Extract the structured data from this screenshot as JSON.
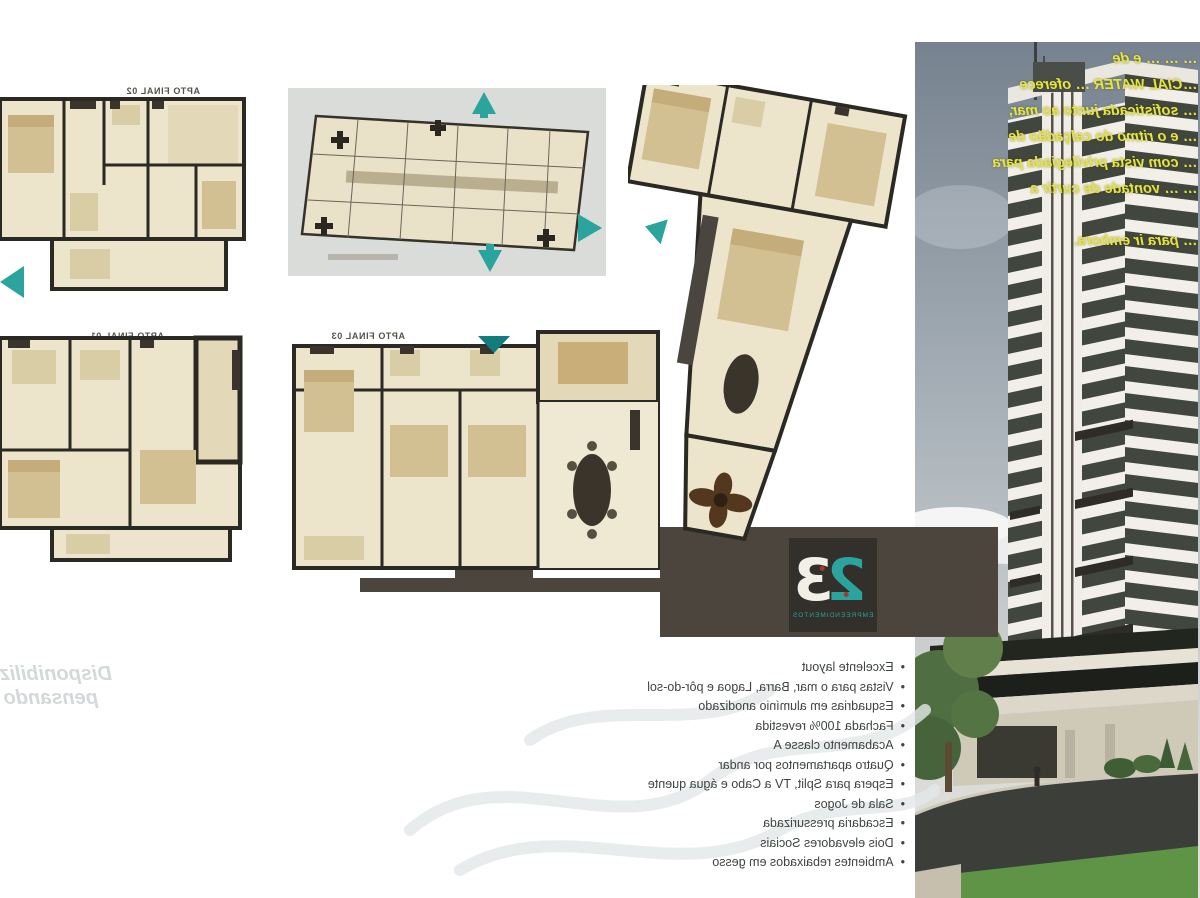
{
  "document": {
    "kind": "real-estate brochure (mirrored print)"
  },
  "plans": {
    "plan_02": {
      "label": "APTO FINAL 02"
    },
    "plan_01": {
      "label": "APTO FINAL 01"
    },
    "plan_03": {
      "label": "APTO FINAL 03"
    },
    "plan_06": {
      "label": "APTO FINAL 06"
    },
    "keyplan": {
      "title": "PAVIMENTO TIPO"
    }
  },
  "logo": {
    "digits_teal": "2",
    "digits_white": "3",
    "caption": "EMPREENDIMENTOS"
  },
  "promo": {
    "lines": [
      "… … … e de",
      "…CIAL WATER … oferece",
      "… sofisticada junto ao mar,",
      "… e o ritmo do calçadão de",
      "… com vista privilegiada para",
      "… … vontade de curtir a",
      "",
      "… para ir embora."
    ]
  },
  "features": {
    "items": [
      "Excelente layout",
      "Vistas para o mar, Barra, Lagoa e pôr-do-sol",
      "Esquadrias em alumínio anodizado",
      "Fachada 100% revestida",
      "Acabamento classe A",
      "Quatro apartamentos por andar",
      "Espera para Split, TV a Cabo e água quente",
      "Sala de Jogos",
      "Escadaria pressurizada",
      "Dois elevadores Sociais",
      "Ambientes rebaixados em gesso"
    ]
  },
  "watermark": {
    "line1": "Disponibilizando ca",
    "line2": "pensando em você e"
  },
  "colors": {
    "accent_teal": "#2aa49c",
    "promo_yellow": "#e6e53c",
    "band_dark": "#4b453e",
    "plan_beige": "#ece4cb",
    "wall_dark": "#2b2923",
    "sky_top": "#76828f",
    "grass_green": "#5f9447"
  }
}
